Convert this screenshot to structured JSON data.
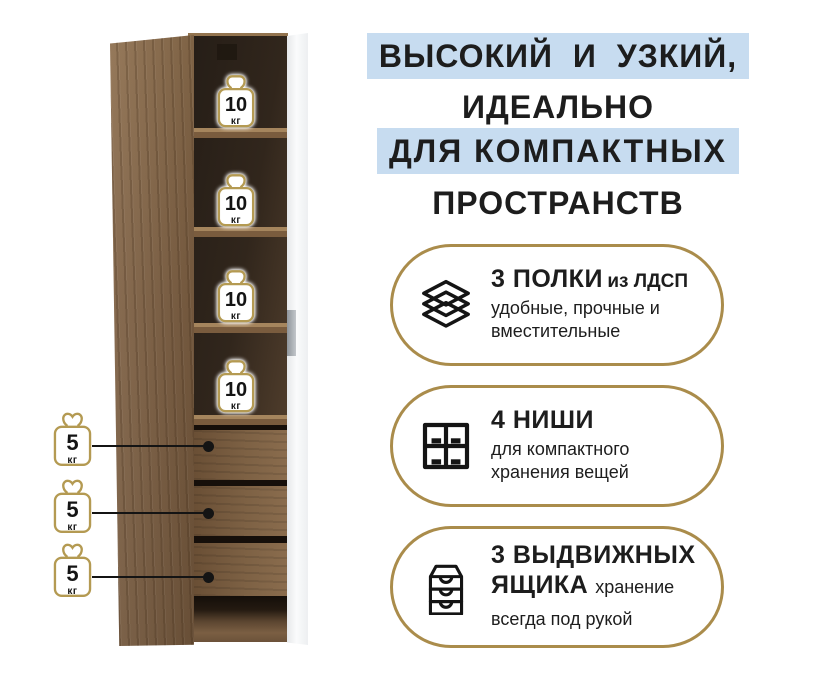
{
  "title": {
    "line1": "ВЫСОКИЙ И УЗКИЙ,",
    "line2": "ИДЕАЛЬНО",
    "line3": "ДЛЯ КОМПАКТНЫХ",
    "line4": "ПРОСТРАНСТВ"
  },
  "capacities": {
    "shelf": {
      "value": "10",
      "unit": "кг"
    },
    "drawer": {
      "value": "5",
      "unit": "кг"
    }
  },
  "features": {
    "shelves": {
      "title": "3 ПОЛКИ",
      "subtitle": "из ЛДСП",
      "description": "удобные, прочные и вместительные",
      "icon": "layers-icon"
    },
    "niches": {
      "title": "4 НИШИ",
      "description": "для компактного хранения вещей",
      "icon": "grid-icon"
    },
    "drawers": {
      "title": "3 ВЫДВИЖНЫХ ЯЩИКА",
      "description": "хранение всегда под рукой",
      "icon": "drawers-icon"
    }
  },
  "colors": {
    "accent_gold": "#aa8c4b",
    "weight_outline_gold": "#b49a52",
    "highlight_blue": "#c7dcf0",
    "text_black": "#1d1d1d",
    "wood_brown": "#7e6043",
    "door_white": "#f5f6f7"
  }
}
